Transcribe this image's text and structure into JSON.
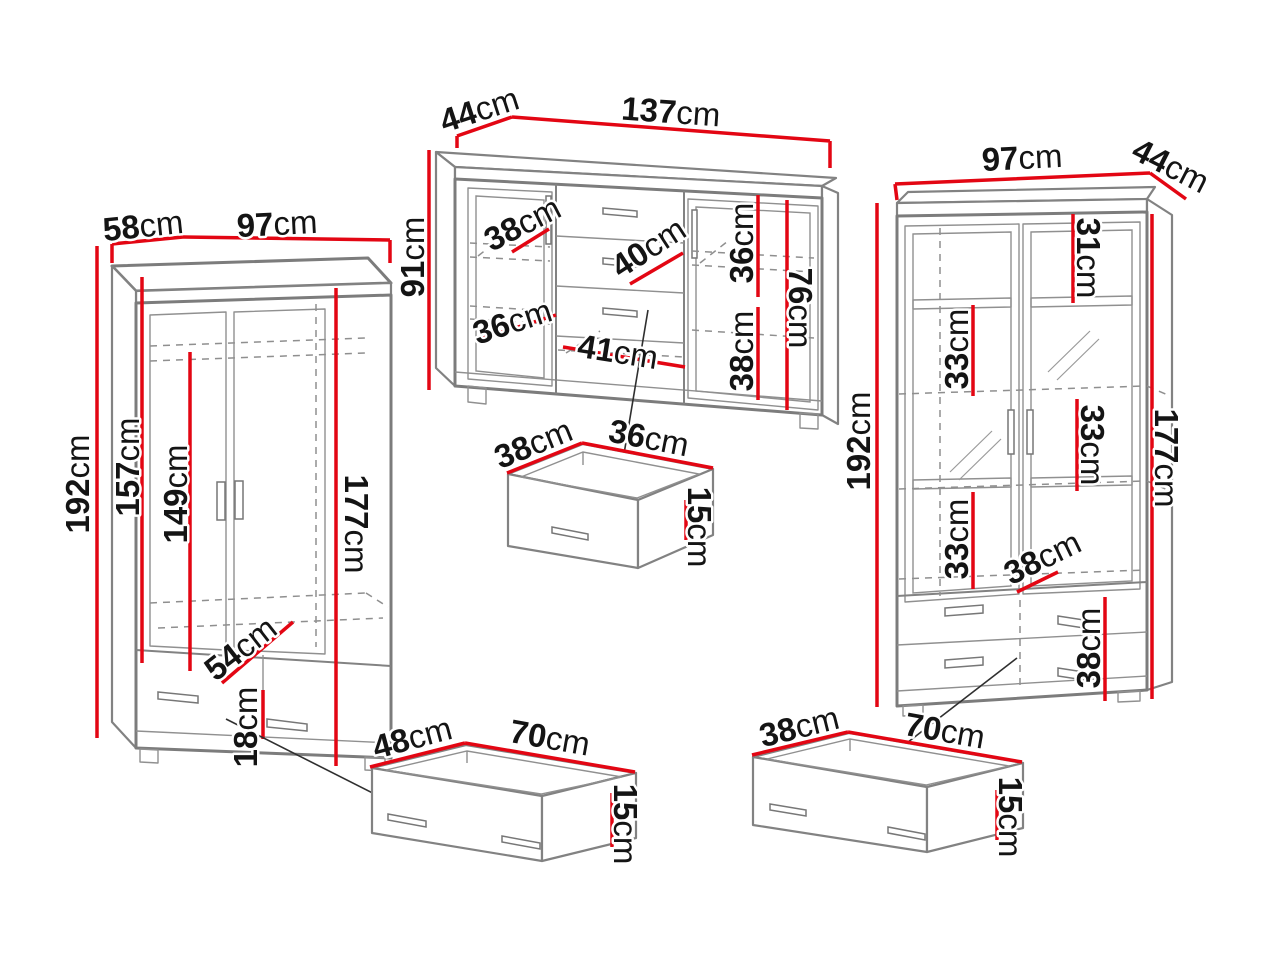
{
  "diagram": {
    "type": "furniture-dimension-diagram",
    "unit": "cm",
    "dimension_line_color": "#e30613",
    "outline_color": "#7c7c7c",
    "background": "#ffffff"
  },
  "wardrobe": {
    "width": "97cm",
    "depth": "58cm",
    "height": "192cm",
    "interior_height_left": "157cm",
    "interior_height_center": "149cm",
    "interior_height_right": "177cm",
    "interior_width": "54cm",
    "drawer_height": "18cm"
  },
  "sideboard": {
    "width": "137cm",
    "depth": "44cm",
    "height": "91cm",
    "left_shelf_width": "38cm",
    "center_drawer_width": "40cm",
    "right_upper_section_height": "36cm",
    "right_lower_section_height": "38cm",
    "interior_height": "76cm",
    "left_lower_shelf_width": "36cm",
    "bottom_compartment_width": "41cm"
  },
  "small_drawer": {
    "width": "36cm",
    "depth": "38cm",
    "height": "15cm"
  },
  "display_cabinet": {
    "width": "97cm",
    "depth": "44cm",
    "height": "192cm",
    "top_section_height": "31cm",
    "upper_shelf_height": "33cm",
    "middle_shelf_height": "33cm",
    "lower_shelf_height": "33cm",
    "interior_width": "38cm",
    "drawer_section_height": "38cm",
    "interior_height": "177cm"
  },
  "underbed_drawer": {
    "width": "70cm",
    "depth": "48cm",
    "height": "15cm"
  },
  "wide_drawer": {
    "width": "70cm",
    "depth": "38cm",
    "height": "15cm"
  }
}
